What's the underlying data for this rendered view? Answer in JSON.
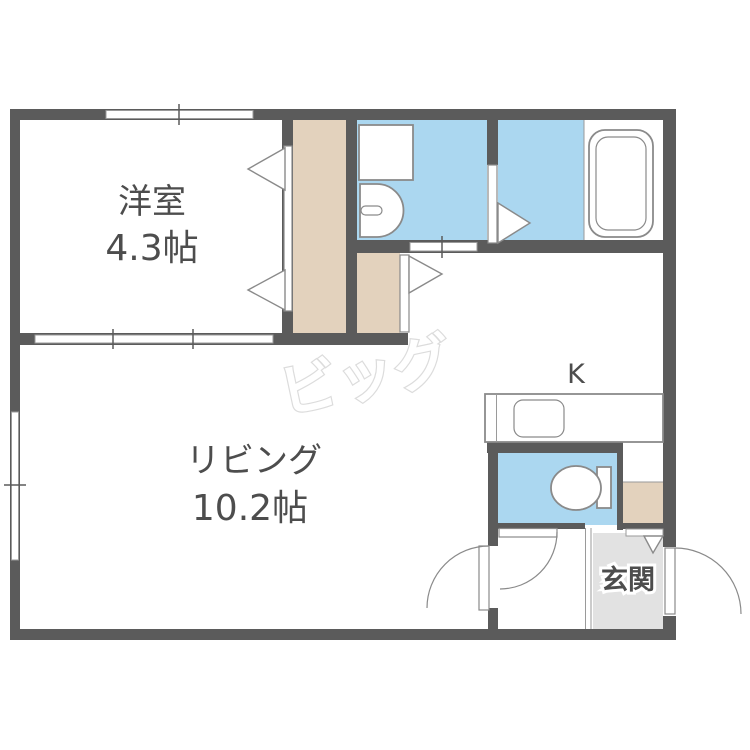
{
  "floor_plan": {
    "watermark": "ビッグ",
    "rooms": {
      "western_room": {
        "name": "洋室",
        "size": "4.3帖"
      },
      "living": {
        "name": "リビング",
        "size": "10.2帖"
      },
      "kitchen": {
        "label": "K"
      },
      "entrance": {
        "label": "玄関"
      }
    },
    "colors": {
      "wall": "#5b5b5b",
      "wet_area_floor": "#abd7f0",
      "closet_floor": "#e3d2bd",
      "entrance_floor": "#e2e2e2",
      "fixture_outline": "#8a8a8a",
      "watermark_outline": "#dcdcdc"
    }
  }
}
